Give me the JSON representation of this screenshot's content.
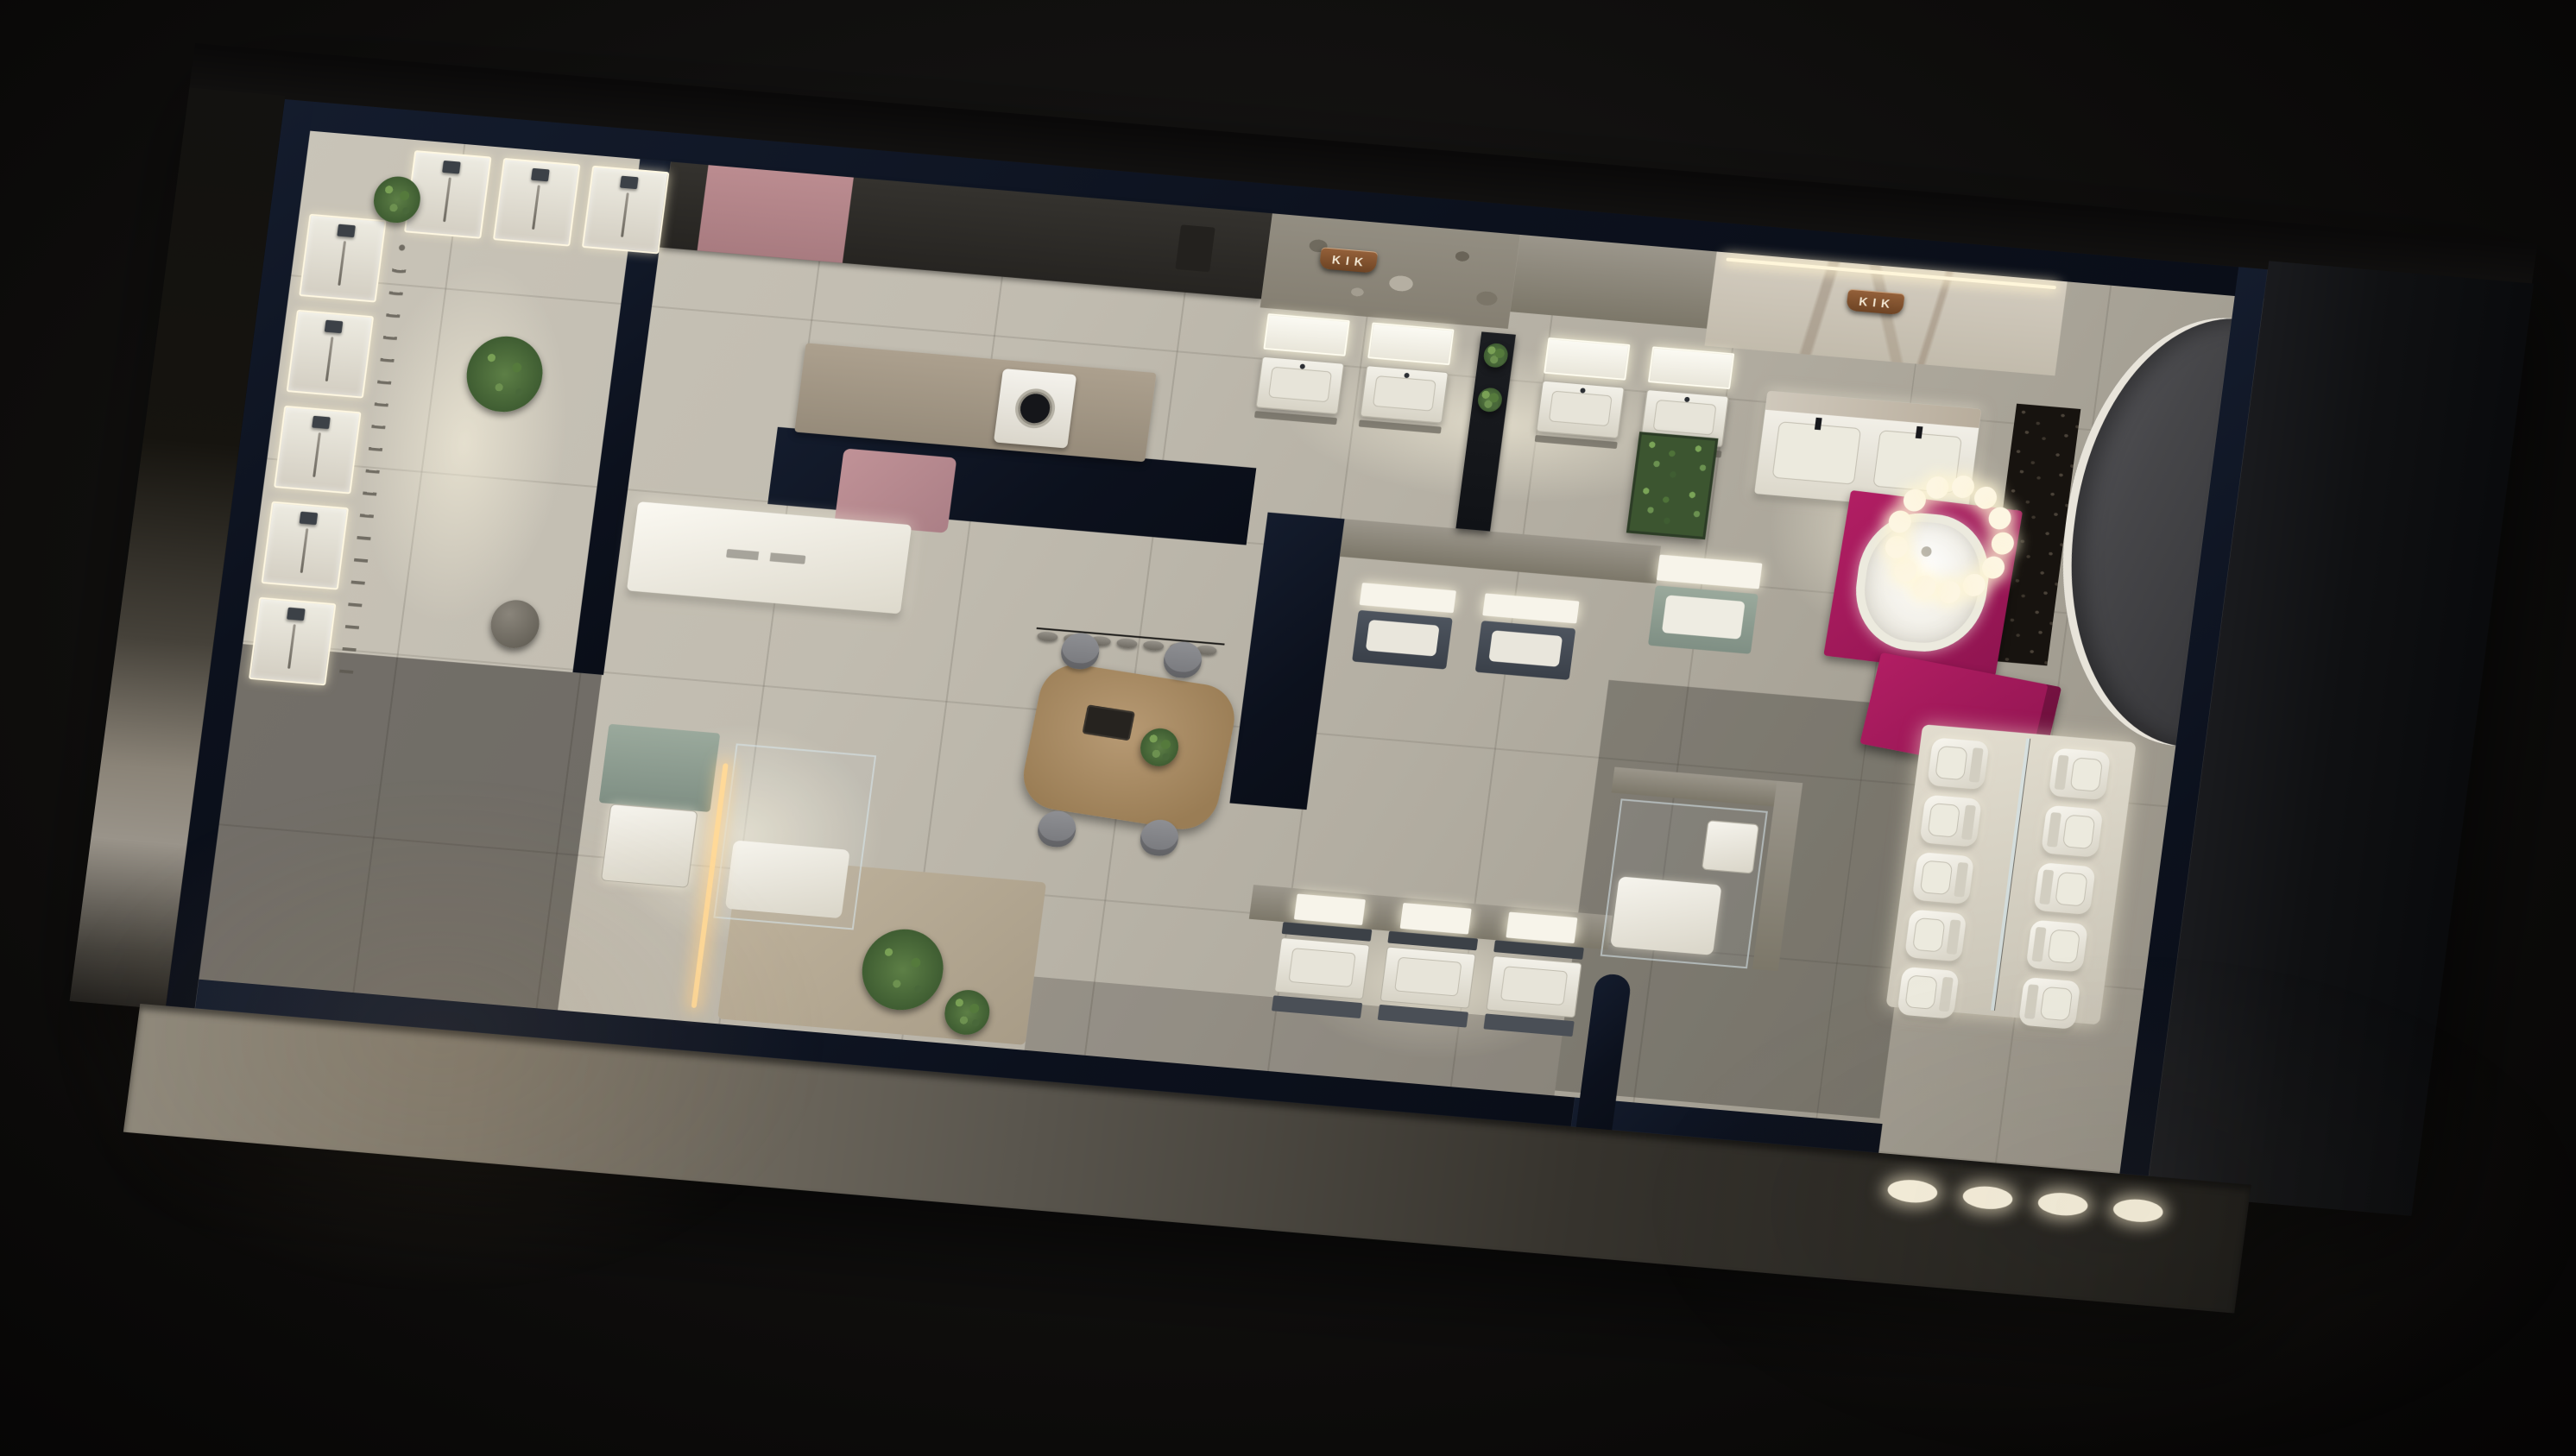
{
  "scene": {
    "title": "KIK bathroom showroom — 3D isometric floor-plan render, night view",
    "style": "photorealistic dollhouse cutaway on dark background",
    "brand": "KIK"
  },
  "signs": {
    "stone_wall": {
      "text": "KIK"
    },
    "marble_wall": {
      "text": "KIK"
    }
  },
  "palette": {
    "background": "#0a0908",
    "wall_top_navy": "#0c111d",
    "floor_tile": "#c1bcb0",
    "stone_wall": "#8d887c",
    "marble_wall": "#cfc8bb",
    "copper_sign": "#7d5130",
    "accent_magenta": "#a6185c",
    "accent_dusty_pink": "#b4878b",
    "sage_green": "#93a396",
    "plant_green": "#5d7f46",
    "wood_table": "#a98e6b",
    "led_warm_white": "#fff6da",
    "fixture_white": "#f2f0e8",
    "charcoal_furniture": "#3a4049"
  },
  "areas": {
    "shower_gallery": {
      "name": "Shower & faucet display gallery",
      "wall_panels": 5,
      "corner_panels": 3,
      "plants": 2,
      "pendant_dome": 1
    },
    "laundry_kitchenette": {
      "name": "Laundry / kitchenette bay",
      "washing_machines": 1,
      "pink_wall_panel": 1,
      "pink_floor_mat": 1
    },
    "north_vanity_row": {
      "name": "Vanity displays on stone wall",
      "left_pair": 2,
      "right_pair": 2,
      "black_shelf_divider": 1
    },
    "island_counter": {
      "name": "White display island with engraved label (illegible)",
      "count": 1
    },
    "consult_table": {
      "name": "Consultation table",
      "chairs": 4,
      "pendant_discs": 7,
      "tray": 1
    },
    "dark_vanity_alcove": {
      "name": "Charcoal vanity alcove",
      "units": 2
    },
    "green_feature": {
      "name": "Plant feature wall + sage vanity",
      "plant_walls": 1,
      "sage_vanities": 1
    },
    "premium_suite": {
      "name": "Premium bath suite (marble wall)",
      "double_vanity_basins": 2,
      "freestanding_tub": 1,
      "magenta_rug": 1,
      "chandelier_bulbs": 13,
      "pebble_strip": 1,
      "arch_niche": 1
    },
    "reception_desk": {
      "name": "Magenta reception desk",
      "count": 1
    },
    "toilet_display": {
      "name": "Toilet display platform",
      "rows": 2,
      "per_row": 5,
      "glass_divider": 1
    },
    "south_vanity_trio": {
      "name": "South vanity displays",
      "units": 3
    },
    "entry_suite": {
      "name": "Entry bath suite with glass shower",
      "plants": 2,
      "glass_showers": 2,
      "led_strip": 1
    },
    "entrance": {
      "name": "Entrance threshold",
      "floor_lights": 4
    }
  }
}
